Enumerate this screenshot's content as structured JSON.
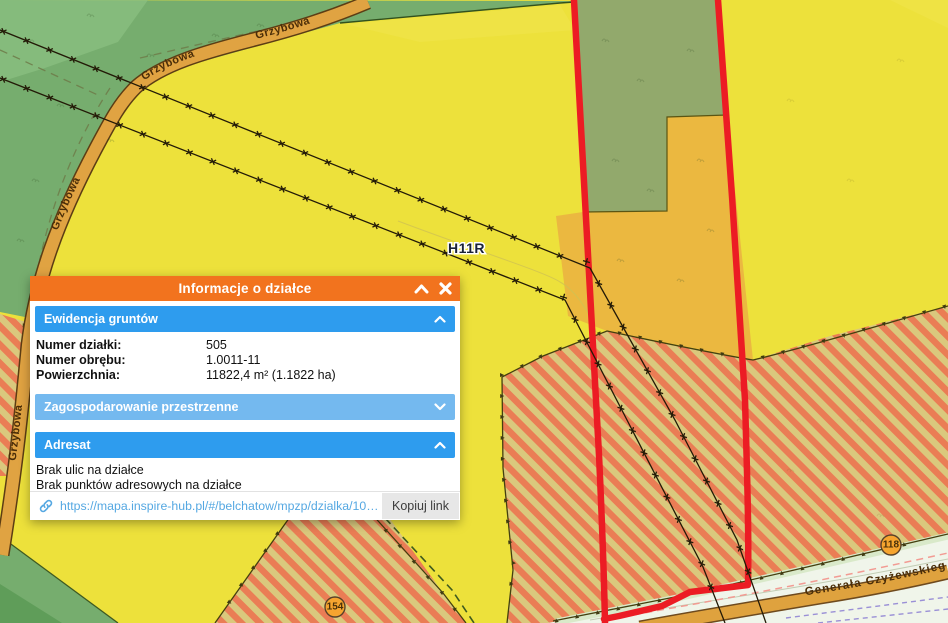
{
  "popup": {
    "title": "Informacje o działce",
    "sections": [
      {
        "title": "Ewidencja gruntów",
        "state": "expanded"
      },
      {
        "title": "Zagospodarowanie przestrzenne",
        "state": "collapsed"
      },
      {
        "title": "Adresat",
        "state": "expanded"
      }
    ],
    "fields": [
      {
        "label": "Numer działki:",
        "value": "505"
      },
      {
        "label": "Numer obrębu:",
        "value": "1.0011-11"
      },
      {
        "label": "Powierzchnia:",
        "value": "11822,4 m² (1.1822 ha)"
      }
    ],
    "adresat_lines": [
      "Brak ulic na działce",
      "Brak punktów adresowych na działce"
    ],
    "footer": {
      "url": "https://mapa.inspire-hub.pl/#/belchatow/mpzp/dzialka/10…",
      "copy_button": "Kopiuj link"
    }
  },
  "map": {
    "labels": {
      "grzybowa": "Grzybowa",
      "generala": "Generała Czyżewskiego",
      "zone": "H11R",
      "badge_right": "118",
      "badge_left": "154"
    },
    "colors": {
      "parcel_outline": "#EC1C24",
      "popup_header": "#F2731E",
      "section_blue": "#2E9CEE",
      "section_blue_light": "#74B9EF",
      "link": "#55A8E2",
      "yellow_zone": "#EDE13B",
      "green_zone": "#76AD6E",
      "parcel_green": "#92A96C",
      "amber_zone": "#EBB840",
      "hatch_base": "#DAC87D",
      "hatch_stripe": "#EA7D55",
      "road_fill": "#E0A342"
    }
  }
}
